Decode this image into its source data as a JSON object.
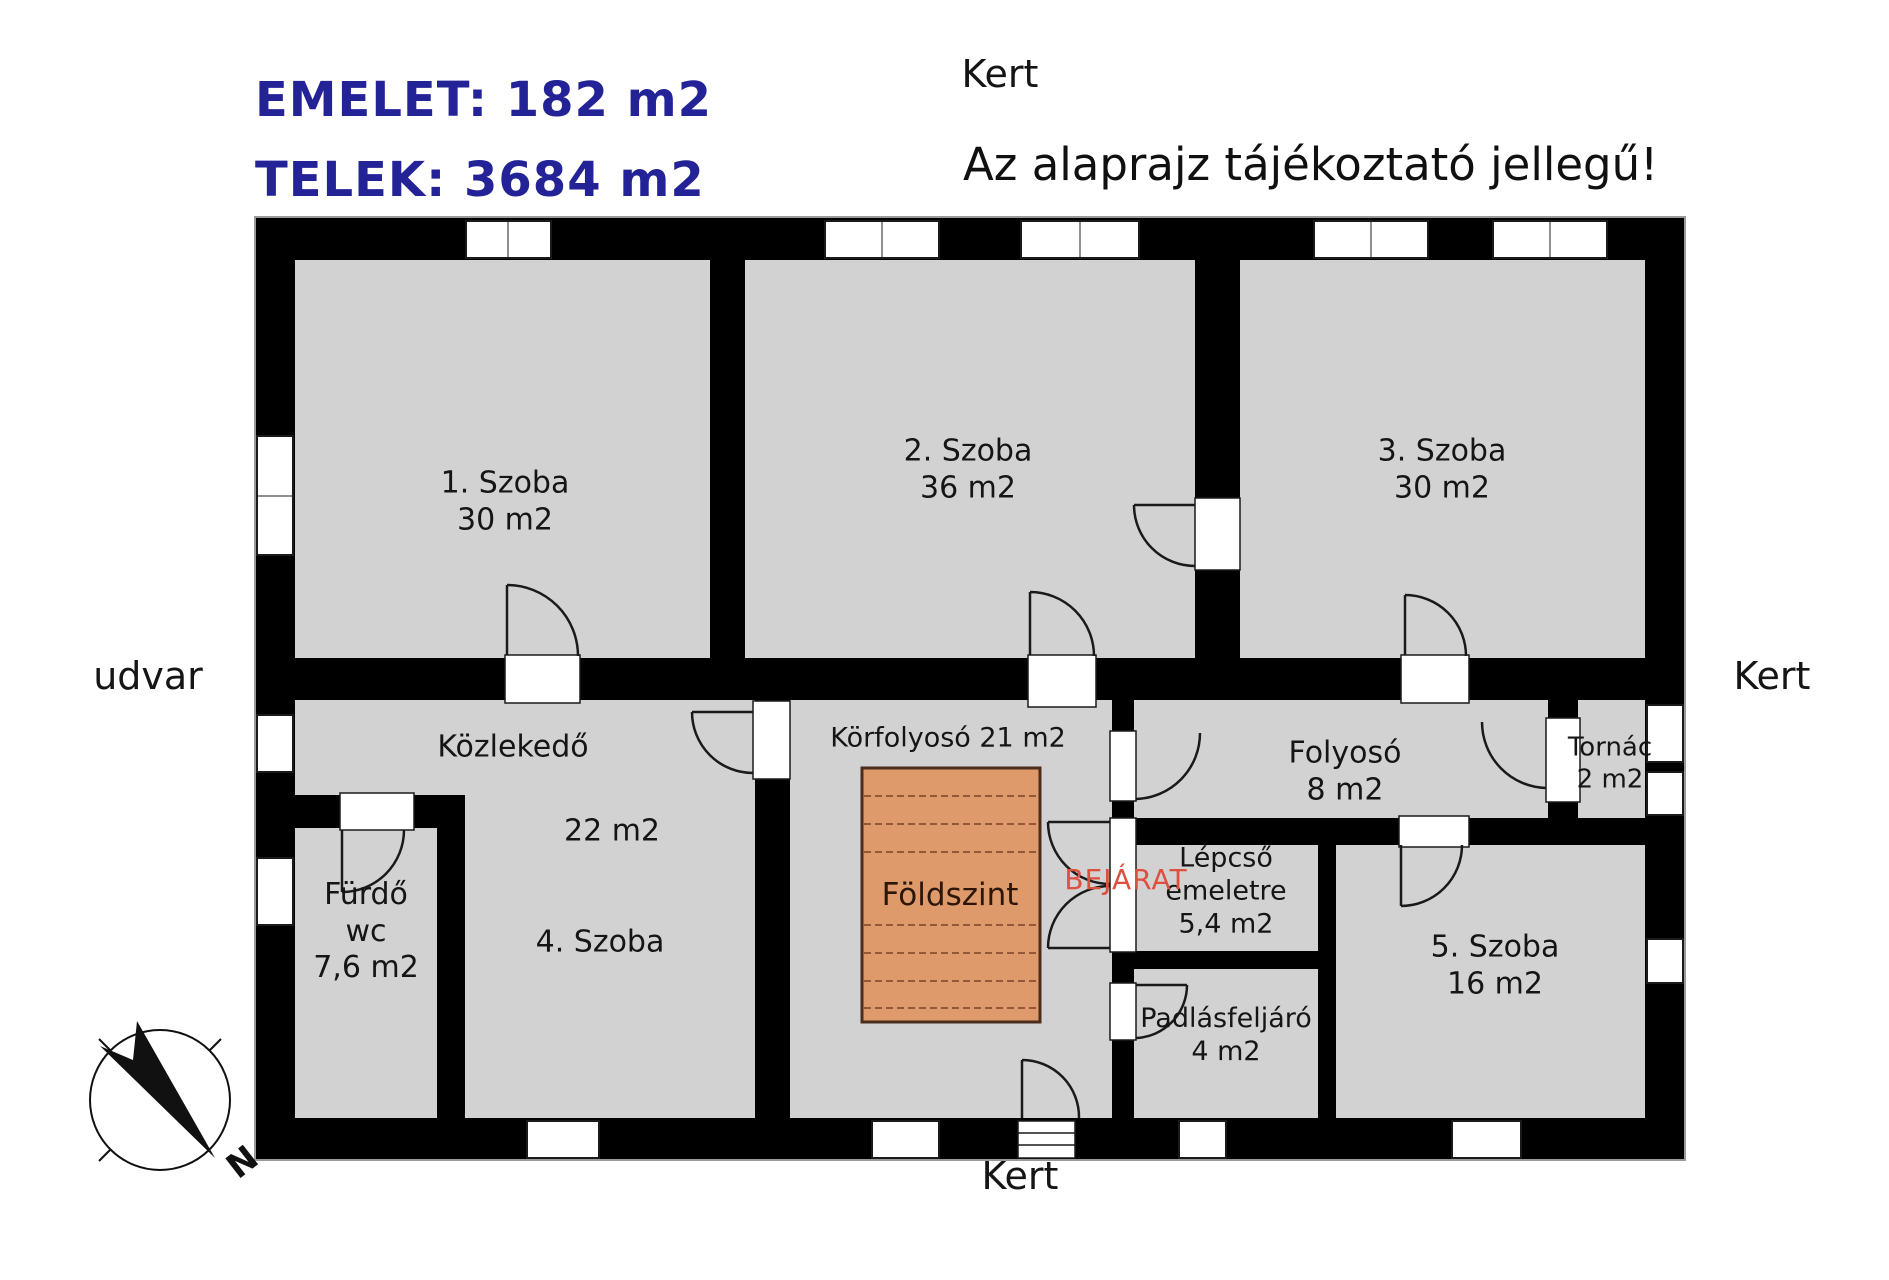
{
  "header": {
    "area_line1": "EMELET: 182 m2",
    "area_line2": "TELEK: 3684 m2",
    "disclaimer": "Az alaprajz tájékoztató jellegű!"
  },
  "surroundings": {
    "top": "Kert",
    "right": "Kert",
    "bottom": "Kert",
    "left": "udvar"
  },
  "rooms": {
    "room1": {
      "name": "1. Szoba",
      "area": "30 m2"
    },
    "room2": {
      "name": "2. Szoba",
      "area": "36 m2"
    },
    "room3": {
      "name": "3. Szoba",
      "area": "30 m2"
    },
    "kozlekedo": {
      "name": "Közlekedő",
      "area": "22 m2"
    },
    "room4": {
      "name": "4. Szoba"
    },
    "furdo": {
      "name": "Fürdő",
      "name2": "wc",
      "area": "7,6 m2"
    },
    "korfolyoso": {
      "name": "Körfolyosó 21 m2"
    },
    "foldszint": {
      "name": "Földszint"
    },
    "folyoso": {
      "name": "Folyosó",
      "area": "8 m2"
    },
    "tornac": {
      "name": "Tornác",
      "area": "2 m2"
    },
    "lepcso": {
      "name": "Lépcső",
      "name2": "emeletre",
      "area": "5,4 m2"
    },
    "padlasfeljaro": {
      "name": "Padlásfeljáró",
      "area": "4 m2"
    },
    "room5": {
      "name": "5. Szoba",
      "area": "16 m2"
    }
  },
  "annotations": {
    "entrance": "BEJÁRAT",
    "compass_letter": "N"
  },
  "colors": {
    "title_text": "#232296",
    "entrance_text": "#dd4f3f",
    "wall": "#000000",
    "room_fill": "#d2d2d2",
    "stairs_fill": "#de9a6b",
    "stairs_line": "#7a4226",
    "background": "#ffffff"
  }
}
